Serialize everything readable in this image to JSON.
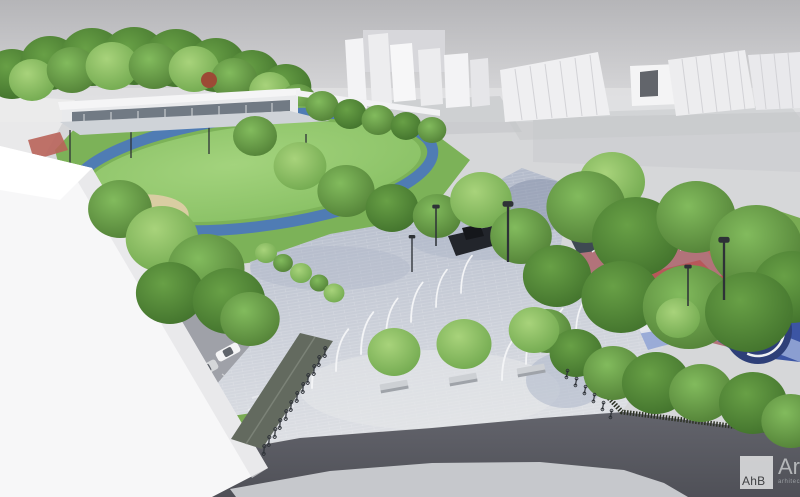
{
  "watermark": {
    "initials": "AhB",
    "studio_name": "Arhi",
    "subtitle": "arhitectura ur"
  },
  "palette": {
    "sky_top": "#b5b5b8",
    "sky_bottom": "#dcdcde",
    "ground": "#d6d7d9",
    "building_white": "#f3f3f5",
    "building_shade": "#d7d7db",
    "massing_rib": "#d2d2d6",
    "tree_light": "#a8d37b",
    "tree_light_edge": "#6fa74d",
    "tree_mid": "#82bb5d",
    "tree_mid_edge": "#507e35",
    "tree_dark": "#68a046",
    "tree_dark_edge": "#40702b",
    "tree_red": "#9c4a35",
    "field_light": "#a3d37d",
    "field_green": "#84bd60",
    "track_blue": "#4f7cb4",
    "sand": "#d9cda2",
    "asphalt": "#9fa1a8",
    "plaza_bright": "#dfe1e5",
    "plaza_shade": "#aeb6c7",
    "road": "#63646c",
    "road_dark": "#4f5057",
    "sidewalk": "#c6c8cc",
    "lawn": "#79ab53",
    "fence": "#2c3124",
    "canopy": "#636a5f",
    "mast_white": "#f3f4f6",
    "lamp": "#2e3237",
    "monument": "#22252b",
    "playground_base": "#b2737a",
    "playground_red": "#b85456",
    "playground_blue": "#3c55a4",
    "playground_lightblue": "#93a6d6",
    "court": "#3e4a52",
    "mural_blue": "#2e3f78",
    "mural_white": "#eff0f3",
    "car_white": "#f4f4f5",
    "car_silver": "#d5d7d9",
    "car_gray": "#9aa0a6",
    "car_dark": "#4a4e55",
    "car_red": "#b03a32",
    "logo_bg": "#d8d9da",
    "logo_text": "#3f4042",
    "logo_name": "#b4b6b9",
    "logo_sub": "#9b9fa3"
  }
}
